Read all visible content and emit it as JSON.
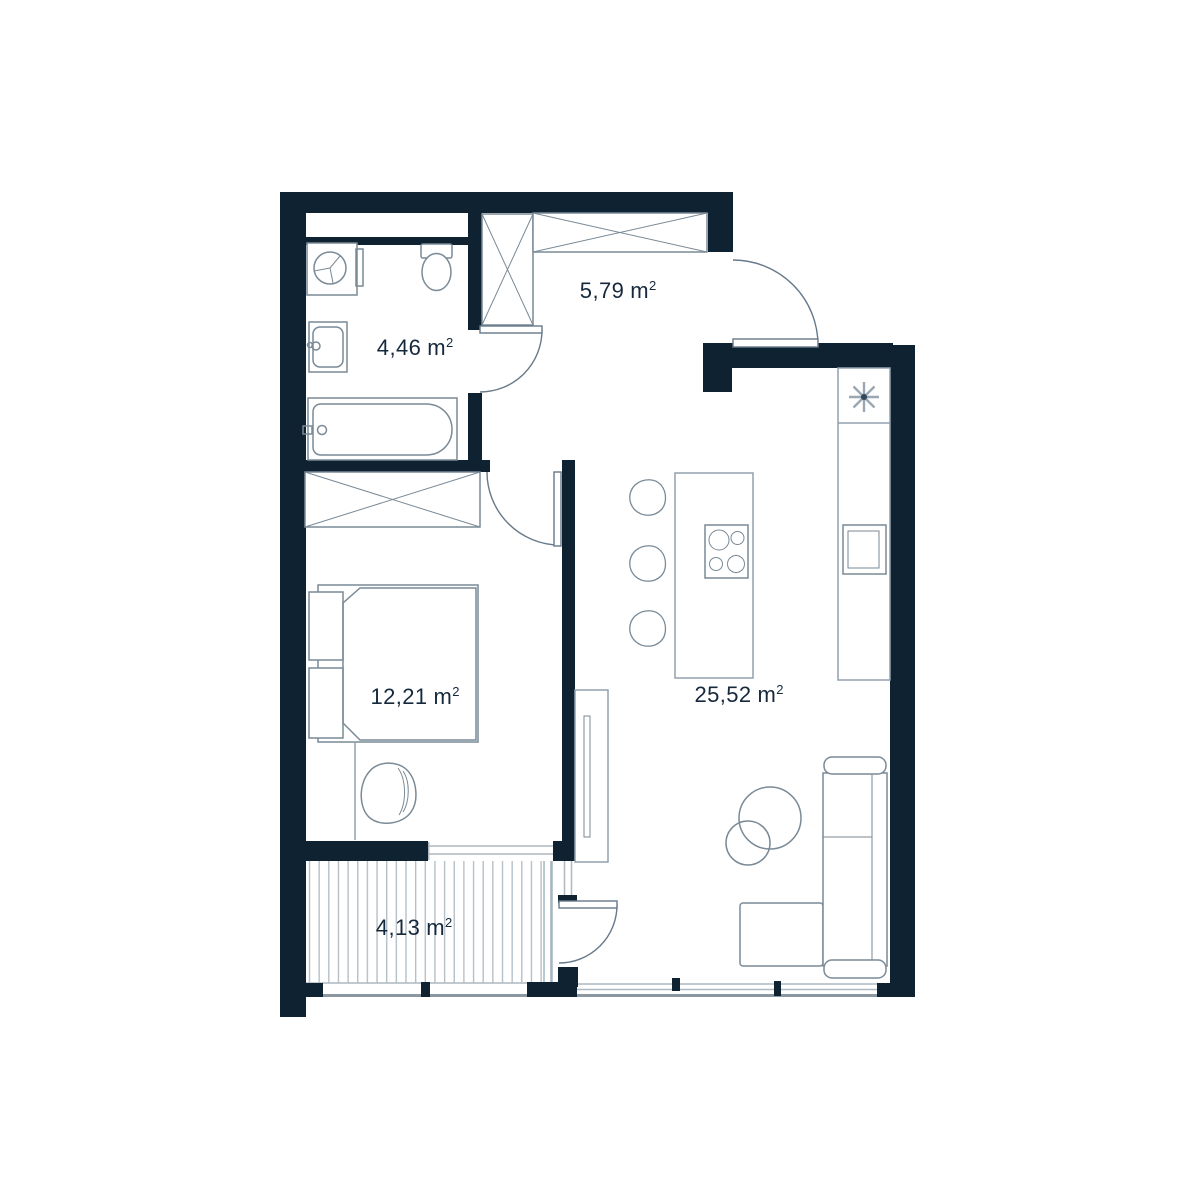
{
  "plan": {
    "rooms": [
      {
        "name": "bathroom",
        "area": "4,46",
        "unit": "m",
        "exponent": "2"
      },
      {
        "name": "hallway",
        "area": "5,79",
        "unit": "m",
        "exponent": "2"
      },
      {
        "name": "bedroom",
        "area": "12,21",
        "unit": "m",
        "exponent": "2"
      },
      {
        "name": "living-room-kitchen",
        "area": "25,52",
        "unit": "m",
        "exponent": "2"
      },
      {
        "name": "balcony",
        "area": "4,13",
        "unit": "m",
        "exponent": "2"
      }
    ],
    "icons": {
      "boiler": "asterisk-icon",
      "washing_machine": "drum-circle-icon",
      "cooktop": "four-burners-icon"
    },
    "colors": {
      "wall": "#0e2231",
      "furniture_line": "#7a8a96",
      "light_line": "#93a1ad",
      "window_line": "#aeb9c1",
      "deck_stripe": "#b6c0c7",
      "text": "#16293c",
      "background": "#ffffff"
    }
  }
}
